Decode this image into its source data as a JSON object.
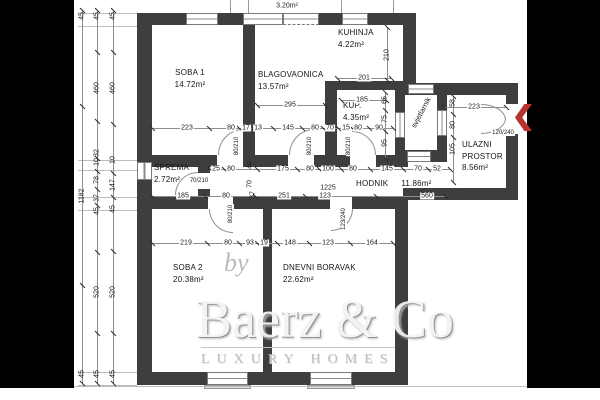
{
  "drawing": {
    "type": "apartment-floor-plan",
    "balcony_area": "3.20m²",
    "wall_color": "#3e3e3e",
    "accent_red": "#b5332a",
    "letterbox_color": "#000000"
  },
  "rooms": {
    "soba1": {
      "name": "SOBA 1",
      "area": "14.72m²"
    },
    "blagovaonica": {
      "name": "BLAGOVAONICA",
      "area": "13.57m²"
    },
    "kuhinja": {
      "name": "KUHINJA",
      "area": "4.22m²"
    },
    "kup": {
      "name": "KUP.",
      "area": "4.35m²"
    },
    "sprema": {
      "name": "SPREMA",
      "area": "2.72m²"
    },
    "hodnik": {
      "name": "HODNIK",
      "area": "11.86m²"
    },
    "ulazni": {
      "name": "ULAZNI",
      "name2": "PROSTOR",
      "area": "8.56m²"
    },
    "soba2": {
      "name": "SOBA 2",
      "area": "20.38m²"
    },
    "dnevni": {
      "name": "DNEVNI BORAVAK",
      "area": "22.62m²"
    },
    "svjetlarnik": {
      "name": "svjetlarnik"
    }
  },
  "watermark": {
    "by": "by",
    "brand": "Baerz & Co",
    "tagline": "LUXURY HOMES"
  },
  "dim_lines": [
    {
      "o": "h",
      "y": 128,
      "x1": 152,
      "x2": 393,
      "labels": [
        {
          "t": "223",
          "x": 187
        },
        {
          "t": "80",
          "x": 231
        },
        {
          "t": "17",
          "x": 246
        },
        {
          "t": "13",
          "x": 258
        },
        {
          "t": "145",
          "x": 288
        },
        {
          "t": "80",
          "x": 315
        },
        {
          "t": "70",
          "x": 330
        },
        {
          "t": "15",
          "x": 346
        },
        {
          "t": "80",
          "x": 358
        },
        {
          "t": "90",
          "x": 379
        }
      ]
    },
    {
      "o": "h",
      "y": 169,
      "x1": 210,
      "x2": 450,
      "labels": [
        {
          "t": "25",
          "x": 216
        },
        {
          "t": "80",
          "x": 231
        },
        {
          "t": "175",
          "x": 283
        },
        {
          "t": "80",
          "x": 310
        },
        {
          "t": "100",
          "x": 328
        },
        {
          "t": "80",
          "x": 353
        },
        {
          "t": "145",
          "x": 387
        },
        {
          "t": "70",
          "x": 418
        },
        {
          "t": "52",
          "x": 437
        }
      ]
    },
    {
      "o": "h",
      "y": 196,
      "x1": 152,
      "x2": 445,
      "labels": [
        {
          "t": "185",
          "x": 183
        },
        {
          "t": "80",
          "x": 226
        },
        {
          "t": "251",
          "x": 284
        },
        {
          "t": "123",
          "x": 325
        },
        {
          "t": "560",
          "x": 427
        }
      ]
    },
    {
      "o": "h",
      "y": 243,
      "x1": 152,
      "x2": 393,
      "labels": [
        {
          "t": "219",
          "x": 186
        },
        {
          "t": "80",
          "x": 228
        },
        {
          "t": "93",
          "x": 250
        },
        {
          "t": "19",
          "x": 264
        },
        {
          "t": "148",
          "x": 290
        },
        {
          "t": "123",
          "x": 328
        },
        {
          "t": "164",
          "x": 372
        }
      ]
    },
    {
      "o": "h",
      "y": 78,
      "x1": 337,
      "x2": 391,
      "labels": [
        {
          "t": "201",
          "x": 364
        }
      ]
    },
    {
      "o": "h",
      "y": 100,
      "x1": 341,
      "x2": 386,
      "labels": [
        {
          "t": "185",
          "x": 362
        }
      ]
    },
    {
      "o": "h",
      "y": 105,
      "x1": 257,
      "x2": 325,
      "labels": [
        {
          "t": "295",
          "x": 290
        }
      ]
    },
    {
      "o": "h",
      "y": 107,
      "x1": 444,
      "x2": 506,
      "labels": [
        {
          "t": "223",
          "x": 474
        }
      ]
    },
    {
      "o": "v",
      "x": 82,
      "y1": 10,
      "y2": 383,
      "labels": [
        {
          "t": "45",
          "y": 16
        },
        {
          "t": "1182",
          "y": 196
        },
        {
          "t": "45",
          "y": 374
        }
      ]
    },
    {
      "o": "v",
      "x": 97,
      "y1": 10,
      "y2": 383,
      "labels": [
        {
          "t": "45",
          "y": 16
        },
        {
          "t": "460",
          "y": 88
        },
        {
          "t": "32",
          "y": 153
        },
        {
          "t": "10",
          "y": 162
        },
        {
          "t": "78",
          "y": 180
        },
        {
          "t": "37",
          "y": 198
        },
        {
          "t": "45",
          "y": 211
        },
        {
          "t": "520",
          "y": 292
        },
        {
          "t": "45",
          "y": 374
        }
      ]
    },
    {
      "o": "v",
      "x": 113,
      "y1": 10,
      "y2": 383,
      "labels": [
        {
          "t": "45",
          "y": 16
        },
        {
          "t": "460",
          "y": 88
        },
        {
          "t": "10",
          "y": 160
        },
        {
          "t": "147",
          "y": 185
        },
        {
          "t": "45",
          "y": 209
        },
        {
          "t": "520",
          "y": 292
        },
        {
          "t": "45",
          "y": 374
        }
      ]
    },
    {
      "o": "v",
      "x": 387,
      "y1": 27,
      "y2": 80,
      "labels": [
        {
          "t": "210",
          "y": 55
        }
      ]
    },
    {
      "o": "v",
      "x": 385,
      "y1": 92,
      "y2": 158,
      "labels": [
        {
          "t": "65",
          "y": 100
        },
        {
          "t": "75",
          "y": 119
        },
        {
          "t": "95",
          "y": 143
        }
      ]
    },
    {
      "o": "v",
      "x": 453,
      "y1": 96,
      "y2": 182,
      "labels": [
        {
          "t": "58",
          "y": 103
        },
        {
          "t": "80",
          "y": 125
        },
        {
          "t": "105",
          "y": 149
        }
      ]
    }
  ],
  "free_labels": [
    {
      "t": "1225",
      "x": 328,
      "y": 188,
      "rot": false
    },
    {
      "t": "40",
      "x": 250,
      "y": 165,
      "rot": true
    },
    {
      "t": "70",
      "x": 250,
      "y": 184,
      "rot": true
    },
    {
      "t": "37",
      "x": 253,
      "y": 195,
      "rot": true
    }
  ],
  "door_labels": [
    {
      "t": "80/210",
      "x": 237,
      "y": 146,
      "rot": true
    },
    {
      "t": "80/210",
      "x": 310,
      "y": 146,
      "rot": true
    },
    {
      "t": "80/210",
      "x": 349,
      "y": 146,
      "rot": true
    },
    {
      "t": "70/210",
      "x": 199,
      "y": 181,
      "rot": false
    },
    {
      "t": "120/240",
      "x": 503,
      "y": 133,
      "rot": false
    },
    {
      "t": "80/210",
      "x": 231,
      "y": 214,
      "rot": true
    },
    {
      "t": "123/240",
      "x": 344,
      "y": 219,
      "rot": true
    }
  ]
}
